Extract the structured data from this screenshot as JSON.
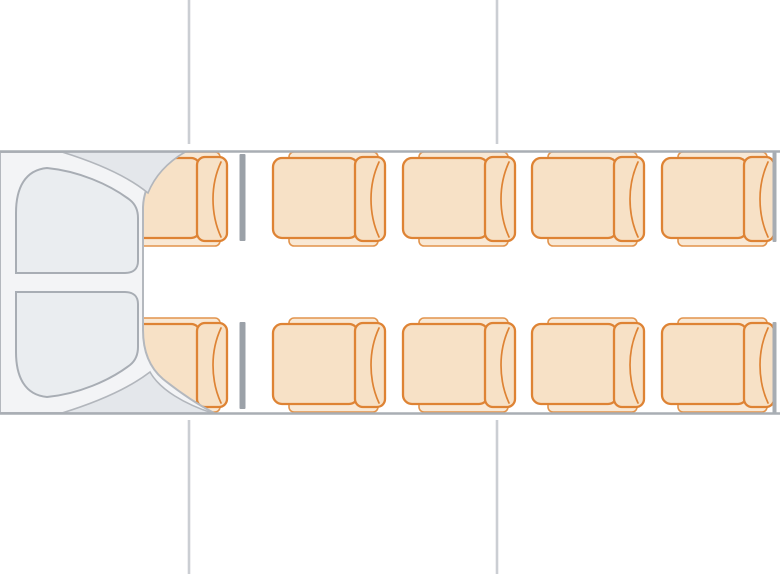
{
  "diagram": {
    "type": "vehicle-seat-map",
    "vehicle": "minibus top view",
    "front_direction": "left",
    "seat_count": 10,
    "rows": [
      {
        "id": "A",
        "name": "top",
        "seats": 5
      },
      {
        "id": "B",
        "name": "bottom",
        "seats": 5
      }
    ],
    "columns": 5,
    "seats": [
      {
        "id": "A1",
        "row": "A",
        "col": 1,
        "x": 115,
        "y": 158
      },
      {
        "id": "A2",
        "row": "A",
        "col": 2,
        "x": 273,
        "y": 158
      },
      {
        "id": "A3",
        "row": "A",
        "col": 3,
        "x": 403,
        "y": 158
      },
      {
        "id": "A4",
        "row": "A",
        "col": 4,
        "x": 532,
        "y": 158
      },
      {
        "id": "A5",
        "row": "A",
        "col": 5,
        "x": 662,
        "y": 158
      },
      {
        "id": "B1",
        "row": "B",
        "col": 1,
        "x": 115,
        "y": 324
      },
      {
        "id": "B2",
        "row": "B",
        "col": 2,
        "x": 273,
        "y": 324
      },
      {
        "id": "B3",
        "row": "B",
        "col": 3,
        "x": 403,
        "y": 324
      },
      {
        "id": "B4",
        "row": "B",
        "col": 4,
        "x": 532,
        "y": 324
      },
      {
        "id": "B5",
        "row": "B",
        "col": 5,
        "x": 662,
        "y": 324
      }
    ],
    "partitions": [
      {
        "id": "front-partition-top",
        "x": 242.5,
        "y1": 154,
        "y2": 241,
        "w": 6
      },
      {
        "id": "front-partition-bottom",
        "x": 242.5,
        "y1": 322,
        "y2": 409,
        "w": 6
      },
      {
        "id": "rear-partition-top",
        "x": 774.5,
        "y1": 152,
        "y2": 242,
        "w": 4
      },
      {
        "id": "rear-partition-bottom",
        "x": 774.5,
        "y1": 322,
        "y2": 414,
        "w": 4
      }
    ],
    "guide_lines": [
      {
        "id": "exterior-divider-top-1",
        "x": 189,
        "y1": 0,
        "y2": 144
      },
      {
        "id": "exterior-divider-top-2",
        "x": 497,
        "y1": 0,
        "y2": 144
      },
      {
        "id": "exterior-divider-bottom-1",
        "x": 189,
        "y1": 420,
        "y2": 574
      },
      {
        "id": "exterior-divider-bottom-2",
        "x": 497,
        "y1": 420,
        "y2": 574
      }
    ],
    "body": {
      "top": 151,
      "bottom": 414,
      "left": 0,
      "right": 780
    },
    "colors": {
      "background": "#ffffff",
      "body_fill": "#ffffff",
      "wall_stroke": "#a9aeb4",
      "seat_fill": "#f7e1c6",
      "seat_stroke": "#de8334",
      "frame_fill": "#f9e8d4",
      "frame_stroke": "#e2944d",
      "cab_fill": "#f3f4f6",
      "cab_stroke": "#b4b8be",
      "wedge_fill": "#e4e7eb",
      "wedge_stroke": "#b2b6bc",
      "panel_fill": "#eaedf0",
      "panel_stroke": "#a8adb4",
      "partition_fill": "#9ba1a8",
      "side_bar_fill": "#a7acb2",
      "guide_line": "#cbced3"
    }
  }
}
